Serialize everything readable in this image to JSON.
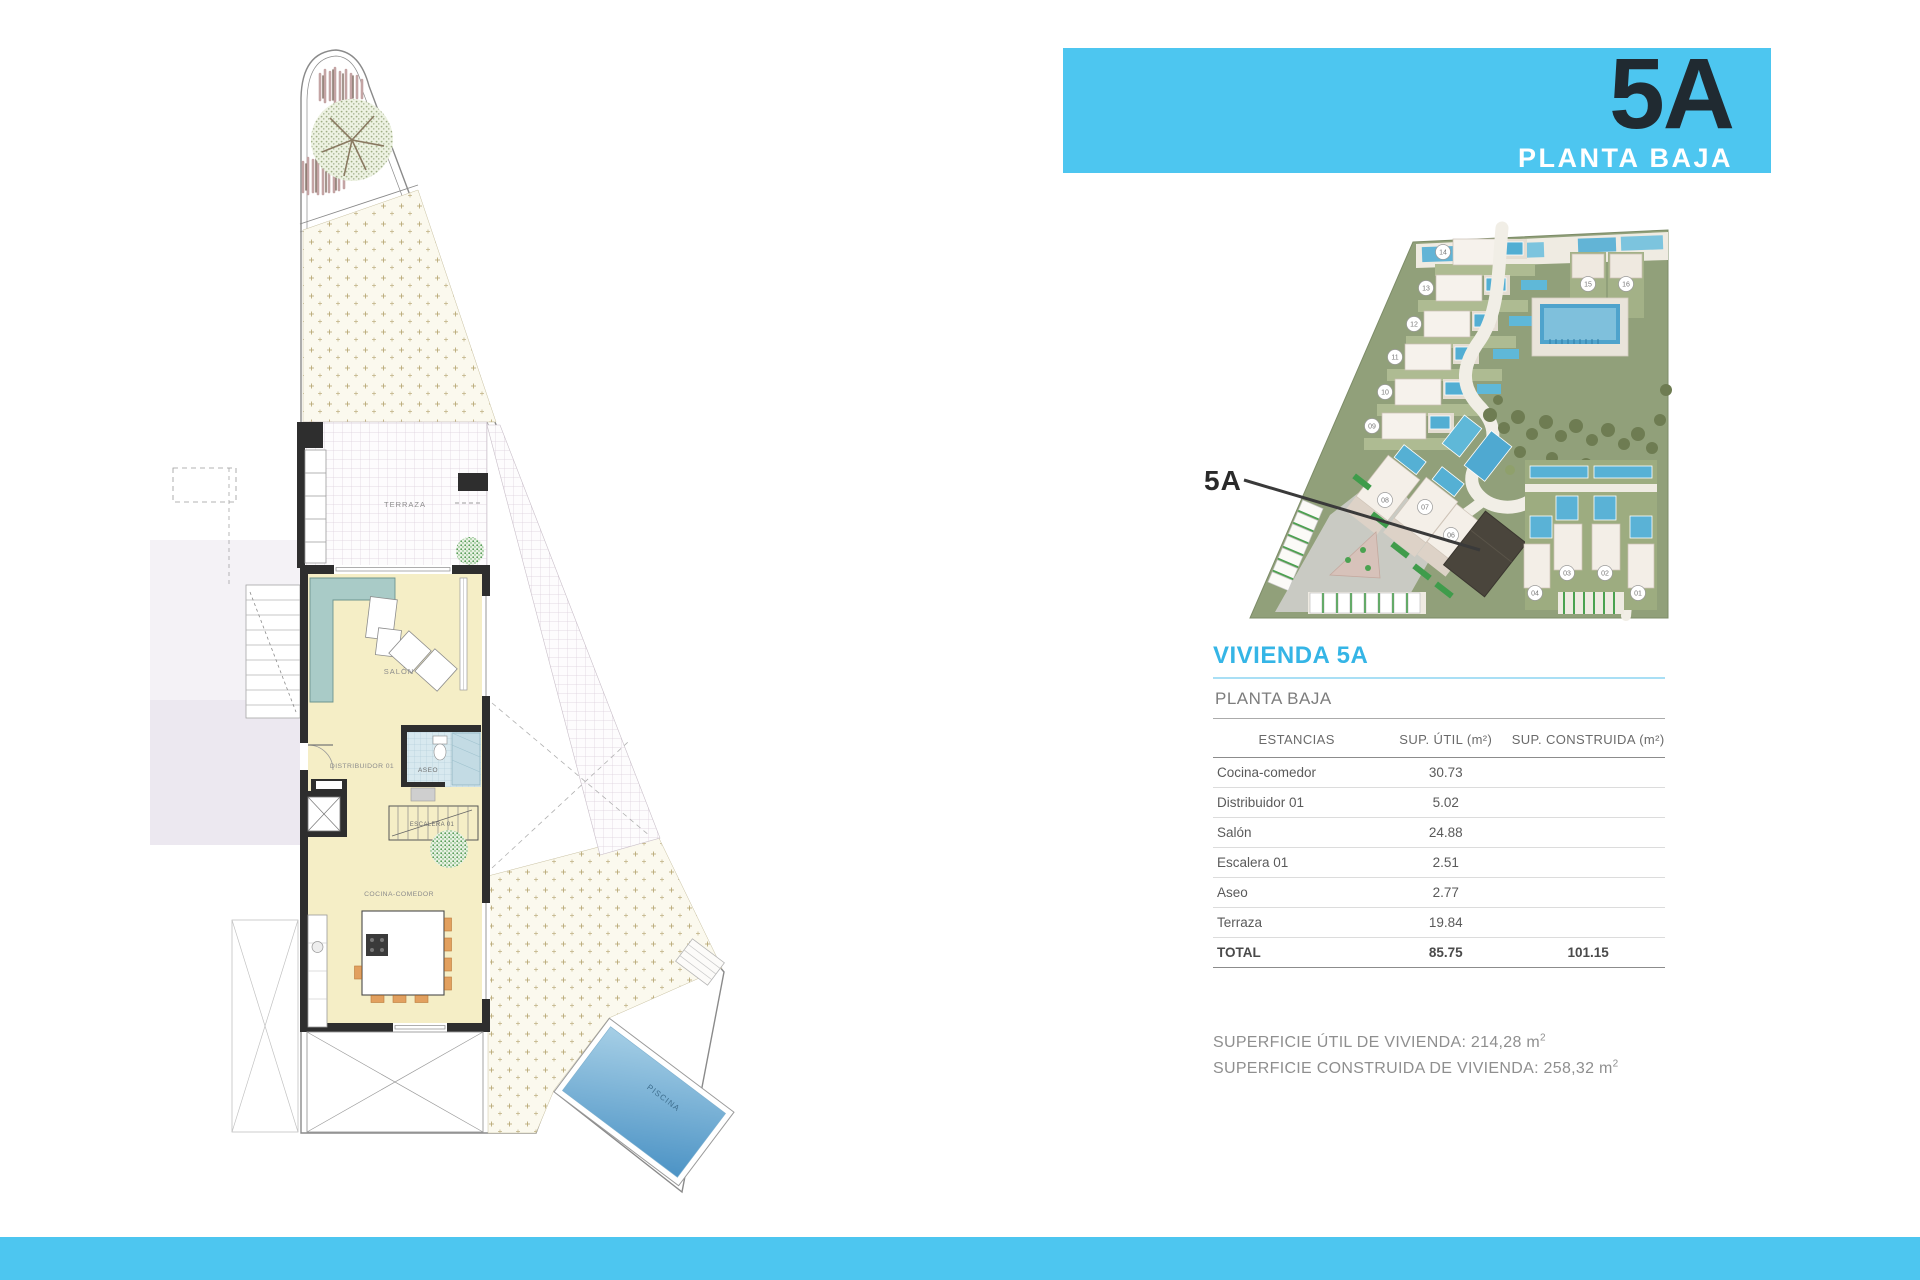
{
  "header": {
    "unit_label": "5A",
    "floor_label": "PLANTA BAJA"
  },
  "colors": {
    "accent": "#4DC6F0",
    "banner_unit_text": "#202A31",
    "title_cyan": "#35B5E6",
    "pool_blue": "#4C93C5",
    "site_green": "#91A07A",
    "highlight_unit_dark": "#4A453C"
  },
  "site_plan": {
    "callout_label": "5A",
    "units": [
      "01",
      "02",
      "03",
      "04",
      "05",
      "06",
      "07",
      "08",
      "09",
      "10",
      "11",
      "12",
      "13",
      "14",
      "15",
      "16"
    ]
  },
  "floor_plan": {
    "labels": {
      "terraza": "TERRAZA",
      "salon": "SALÓN",
      "distribuidor": "DISTRIBUIDOR 01",
      "aseo": "ASEO",
      "escalera": "ESCALERA 01",
      "cocina": "COCINA-COMEDOR",
      "piscina": "PISCINA"
    }
  },
  "info": {
    "title": "VIVIENDA 5A",
    "subtitle": "PLANTA BAJA",
    "table": {
      "headers": [
        "ESTANCIAS",
        "SUP. ÚTIL (m²)",
        "SUP. CONSTRUIDA (m²)"
      ],
      "rows": [
        {
          "name": "Cocina-comedor",
          "util": "30.73",
          "cons": ""
        },
        {
          "name": "Distribuidor 01",
          "util": "5.02",
          "cons": ""
        },
        {
          "name": "Salón",
          "util": "24.88",
          "cons": ""
        },
        {
          "name": "Escalera 01",
          "util": "2.51",
          "cons": ""
        },
        {
          "name": "Aseo",
          "util": "2.77",
          "cons": ""
        },
        {
          "name": "Terraza",
          "util": "19.84",
          "cons": ""
        }
      ],
      "total": {
        "name": "TOTAL",
        "util": "85.75",
        "cons": "101.15"
      }
    },
    "summary": [
      {
        "text": "SUPERFICIE ÚTIL DE VIVIENDA: 214,28 m",
        "sup": "2"
      },
      {
        "text": "SUPERFICIE CONSTRUIDA DE VIVIENDA: 258,32 m",
        "sup": "2"
      }
    ]
  }
}
